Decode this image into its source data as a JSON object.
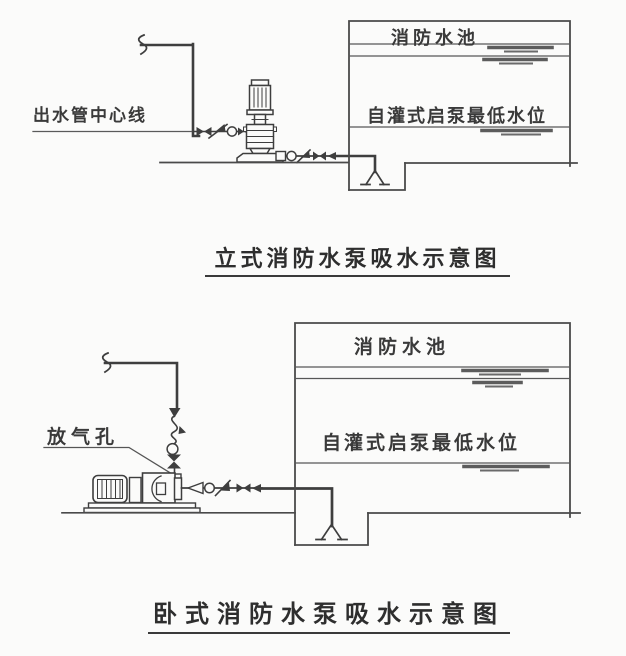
{
  "canvas": {
    "background": "#fbfbfa",
    "line_color": "#3e3e3e",
    "wall_color": "#4a4a4a",
    "water_mark_color": "#5c5c5c",
    "text_color": "#3a3a3a"
  },
  "top_diagram": {
    "labels": {
      "outlet_centerline": "出水管中心线",
      "tank_title": "消防水池",
      "min_water_level": "自灌式启泵最低水位"
    },
    "caption": "立式消防水泵吸水示意图",
    "symbols": [
      "pipe-break-icon",
      "gate-valve-icon",
      "check-valve-icon",
      "flexible-joint-icon",
      "vertical-multistage-pump",
      "eccentric-reducer-icon",
      "flow-arrow-icon",
      "foot-valve-icon",
      "water-level-icon"
    ]
  },
  "bottom_diagram": {
    "labels": {
      "air_vent": "放气孔",
      "tank_title": "消防水池",
      "min_water_level": "自灌式启泵最低水位"
    },
    "caption": "卧式消防水泵吸水示意图",
    "symbols": [
      "pipe-break-icon",
      "flow-arrow-icon",
      "check-valve-icon",
      "flexible-joint-icon",
      "gate-valve-icon",
      "air-vent-fitting",
      "horizontal-pump",
      "eccentric-reducer-icon",
      "foot-valve-icon",
      "water-level-icon"
    ]
  }
}
